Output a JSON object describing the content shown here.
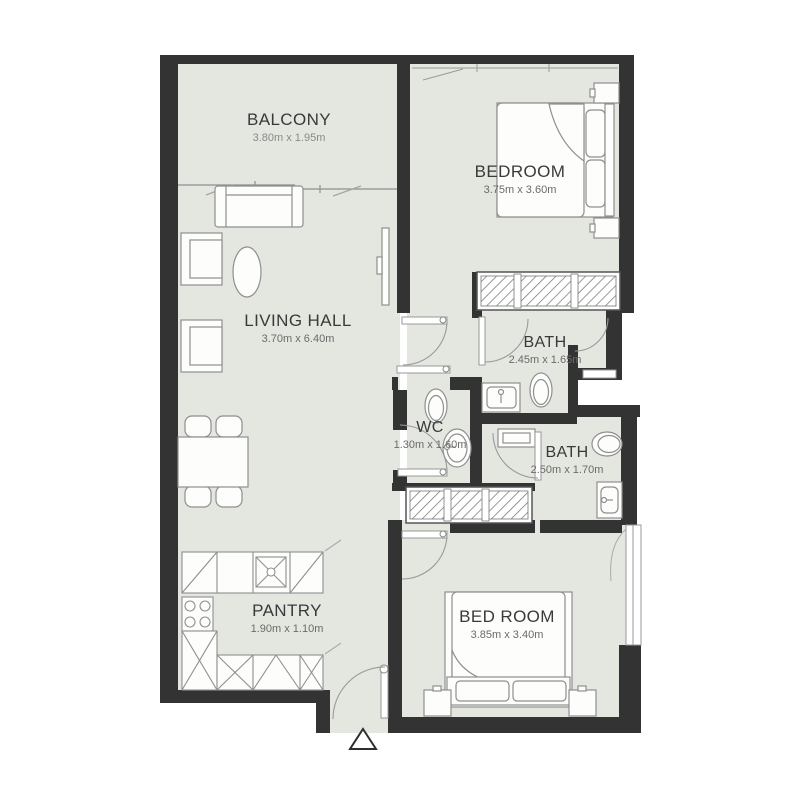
{
  "rooms": {
    "balcony": {
      "name": "BALCONY",
      "dims": "3.80m x 1.95m"
    },
    "bedroom1": {
      "name": "BEDROOM",
      "dims": "3.75m x 3.60m"
    },
    "living_hall": {
      "name": "LIVING HALL",
      "dims": "3.70m x 6.40m"
    },
    "bath1": {
      "name": "BATH",
      "dims": "2.45m x 1.65m"
    },
    "wc": {
      "name": "WC",
      "dims": "1.30m x 1.60m"
    },
    "bath2": {
      "name": "BATH",
      "dims": "2.50m x 1.70m"
    },
    "pantry": {
      "name": "PANTRY",
      "dims": "1.90m x 1.10m"
    },
    "bedroom2": {
      "name": "BED ROOM",
      "dims": "3.85m x 3.40m"
    }
  },
  "markers": {
    "entrance": "triangle-up"
  },
  "colors": {
    "wall": "#333333",
    "floor": "#e4e6e0",
    "line": "#8f8f8f",
    "label": "#3a3a3a",
    "dims": "#6b6b6b"
  }
}
